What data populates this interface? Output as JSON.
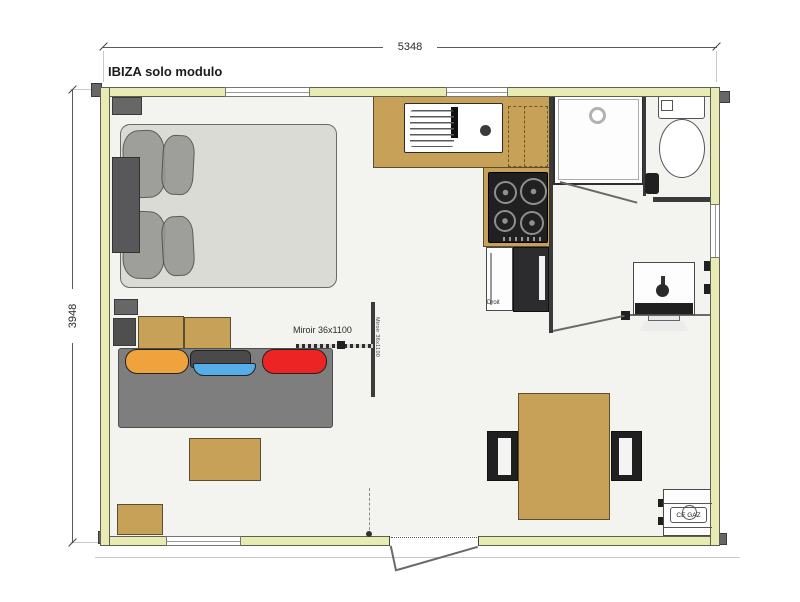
{
  "title": "IBIZA solo modulo",
  "dimensions": {
    "width_mm": "5348",
    "height_mm": "3948"
  },
  "labels": {
    "mirror_h": "Miroir 36x1100",
    "mirror_v": "Miroir 36x1100",
    "door_hinge": "Droit",
    "gas_box": "CE GAZ"
  },
  "colors": {
    "wall": "#e9ecb2",
    "wood": "#c8a159",
    "floor": "#f3f3f0",
    "line": "#3a3a3a",
    "sofa": "#7e7e7e",
    "mattress": "#dbdbd5",
    "pillow": "#969692",
    "appliance": "#202020",
    "cushion_orange": "#f0a23c",
    "cushion_red": "#ec2424",
    "cushion_blue": "#57ade8"
  },
  "items": [
    "double-bed",
    "pillows",
    "headboard",
    "nightstand",
    "wardrobe",
    "sofa",
    "seat-cushions",
    "coffee-table",
    "storage-box",
    "kitchen-counter",
    "kitchen-sink",
    "gas-hob",
    "overhead-cabinet",
    "cabinet",
    "fridge",
    "shower",
    "shower-drain",
    "toilet",
    "tv-unit",
    "desk-shelf",
    "dining-table",
    "dining-chairs",
    "gas-bottle-box",
    "windows",
    "entry-door"
  ]
}
